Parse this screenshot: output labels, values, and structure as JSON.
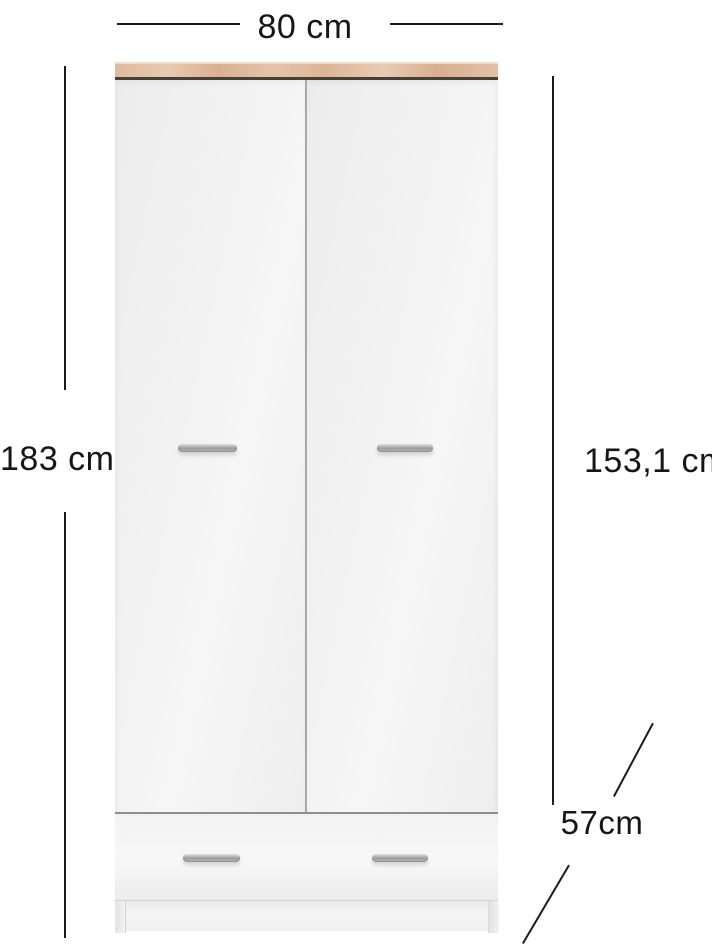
{
  "diagram": {
    "type": "furniture-dimension-diagram",
    "subject": "two-door wardrobe with bottom drawer",
    "annotations": {
      "width_label": "80 cm",
      "height_label": "183 cm",
      "door_height_label": "153,1 cm",
      "depth_label": "57cm"
    },
    "colors": {
      "background": "#ffffff",
      "dimension_line": "#1b1b1b",
      "label_text": "#161616",
      "wood_top": "#debba0",
      "top_trim": "#463f38",
      "door_panel": "#f1f1f1",
      "door_divider": "#9c9c9c",
      "handle_chrome": "#9a9a9a",
      "drawer_line": "#8d8d8d",
      "plinth": "#f0f0f0"
    }
  }
}
